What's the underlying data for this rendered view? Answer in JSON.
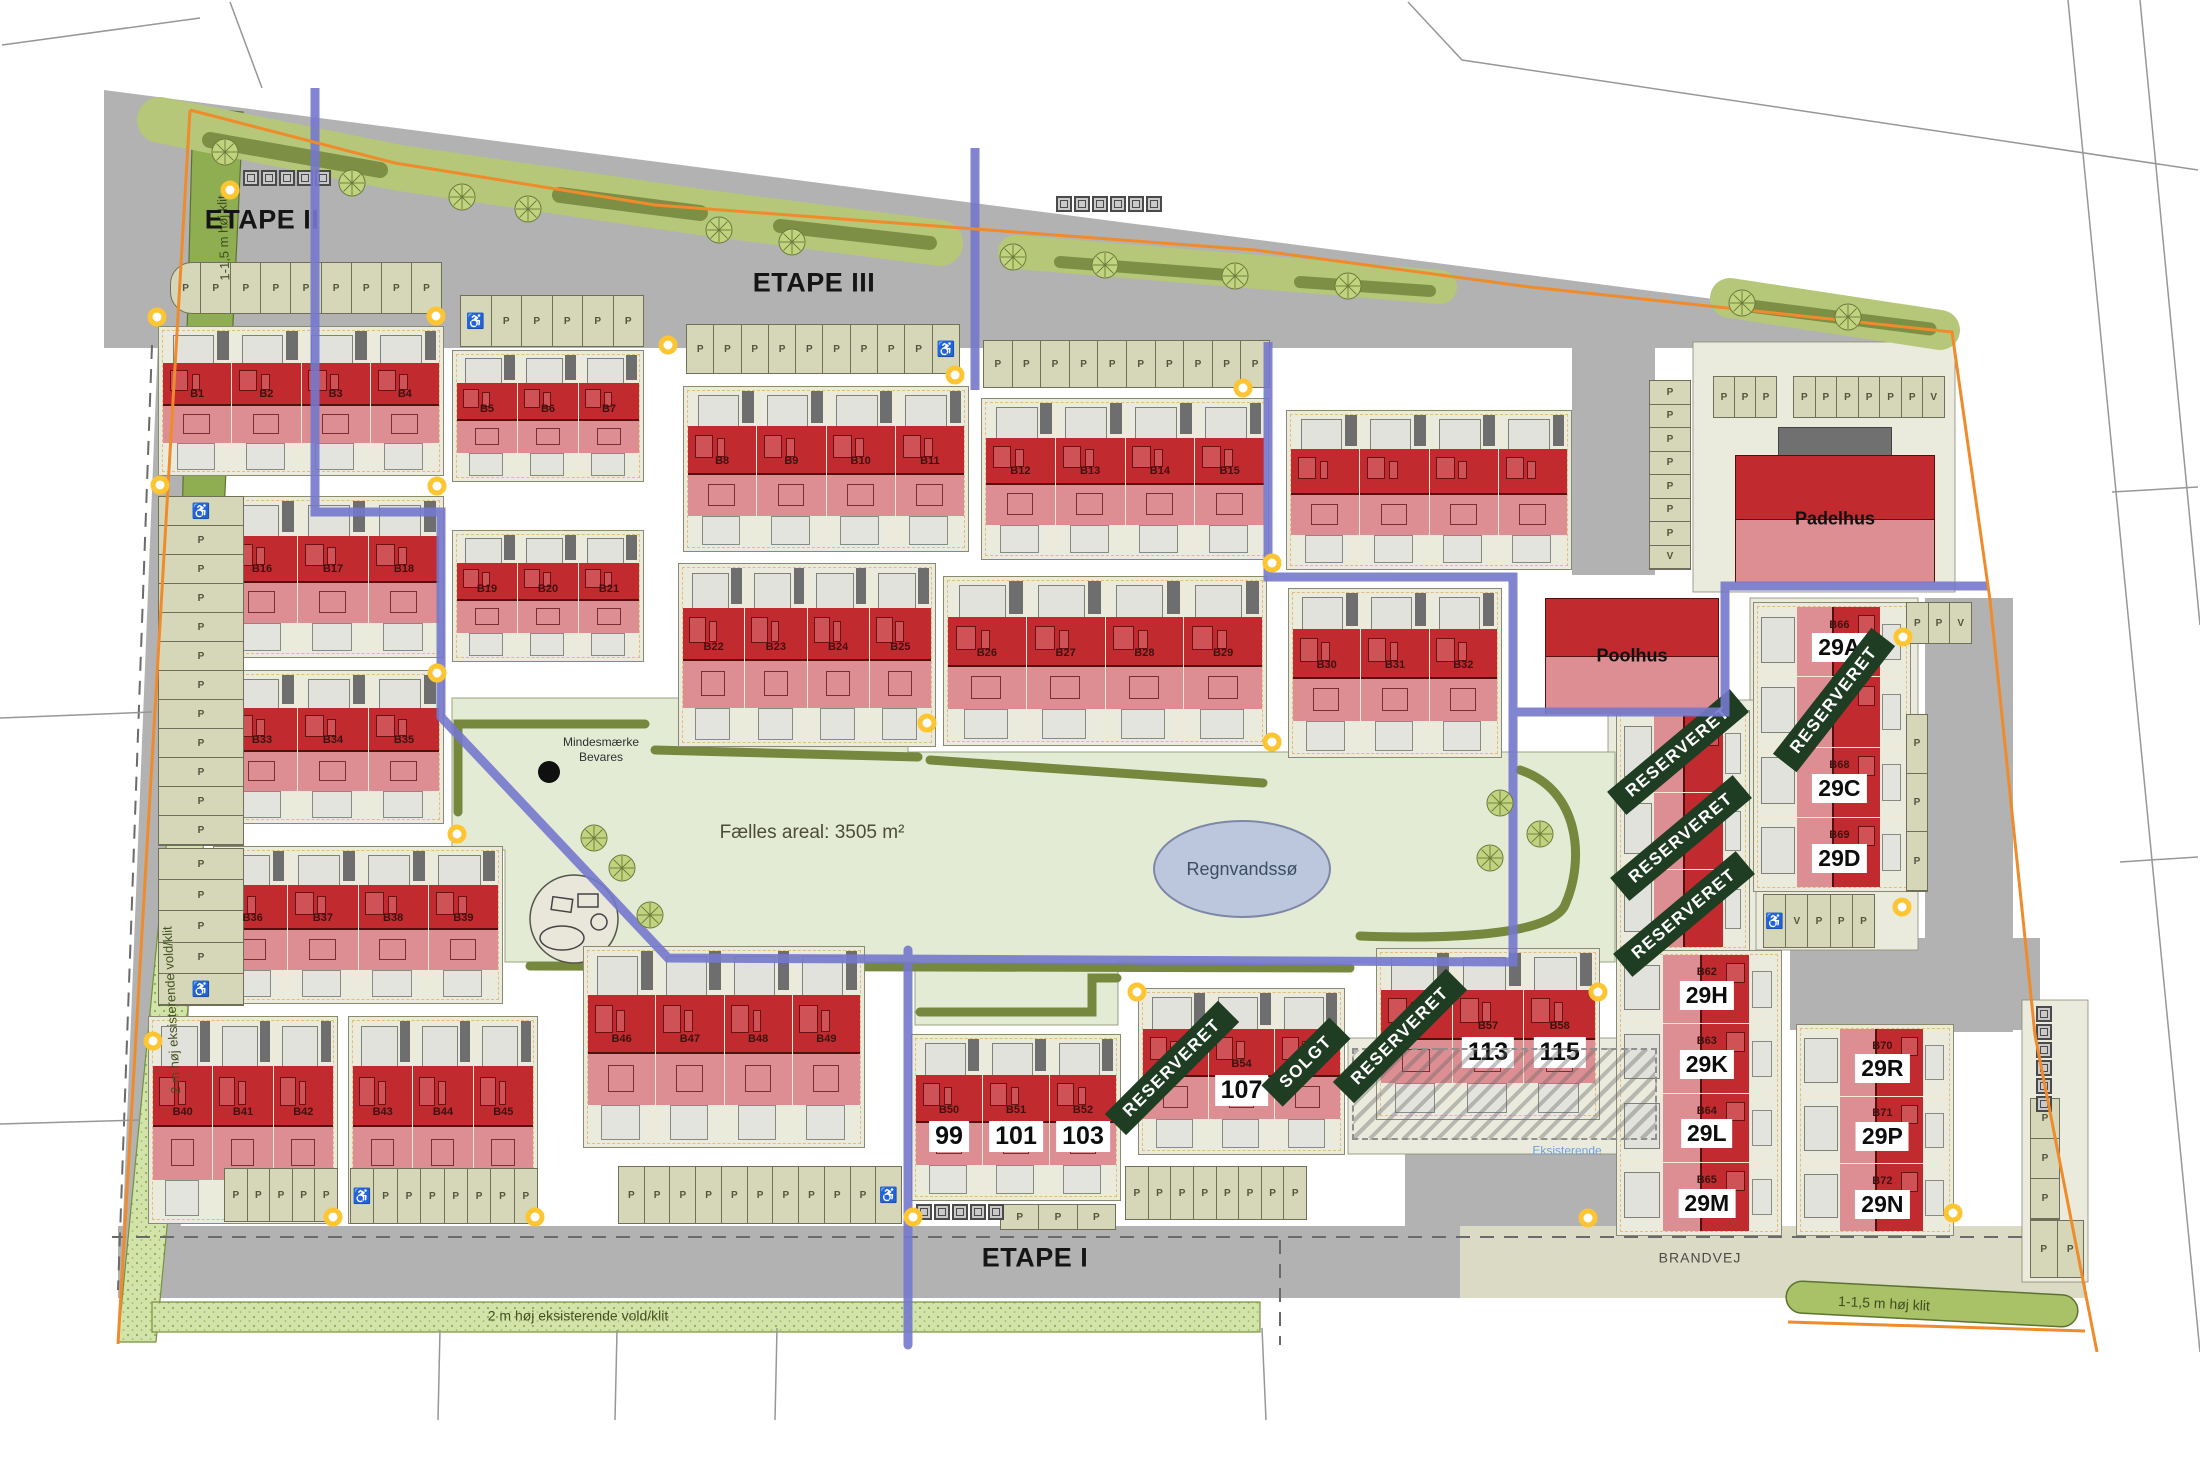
{
  "map": {
    "phases": [
      {
        "id": "etape-2",
        "label": "ETAPE II",
        "x": 262,
        "y": 220
      },
      {
        "id": "etape-3",
        "label": "ETAPE III",
        "x": 814,
        "y": 283
      },
      {
        "id": "etape-1",
        "label": "ETAPE I",
        "x": 1035,
        "y": 1258
      }
    ],
    "area_labels": [
      {
        "id": "faelles-areal",
        "text": "Fælles areal: 3505 m²",
        "x": 812,
        "y": 833,
        "size": 19,
        "color": "#4c4c38",
        "weight": 400
      },
      {
        "id": "regnvandssoe",
        "text": "Regnvandssø",
        "x": 1242,
        "y": 869,
        "size": 18,
        "color": "#3d4e63",
        "weight": 400
      },
      {
        "id": "mindesmaerke",
        "text": "Mindesmærke\nBevares",
        "x": 601,
        "y": 750,
        "size": 12,
        "color": "#2f2f2f",
        "weight": 400
      },
      {
        "id": "brandvej",
        "text": "BRANDVEJ",
        "x": 1700,
        "y": 1258,
        "size": 14,
        "color": "#4a4a4a",
        "weight": 400,
        "spacing": 1
      },
      {
        "id": "eksisterende",
        "text": "Eksisterende",
        "x": 1567,
        "y": 1151,
        "size": 12,
        "color": "#6f9fd8",
        "weight": 400
      },
      {
        "id": "klit-left",
        "text": "1-1,5 m høj klit",
        "x": 224,
        "y": 238,
        "size": 13,
        "color": "#3f4c1f",
        "rot": -92,
        "weight": 400
      },
      {
        "id": "vold-left",
        "text": "2 m høj eksisterende vold/klit",
        "x": 172,
        "y": 1010,
        "size": 13,
        "color": "#44521f",
        "rot": -93,
        "weight": 400
      },
      {
        "id": "vold-bottom",
        "text": "2 m høj eksisterende vold/klit",
        "x": 578,
        "y": 1316,
        "size": 14,
        "color": "#44521f",
        "rot": 0,
        "weight": 400
      },
      {
        "id": "klit-bottom-right",
        "text": "1-1,5 m høj klit",
        "x": 1884,
        "y": 1304,
        "size": 14,
        "color": "#3f4c1f",
        "rot": 3,
        "weight": 400
      }
    ],
    "special_buildings": [
      {
        "name": "Padelhus",
        "lot": [
          1693,
          342,
          262,
          250
        ],
        "bld": [
          1735,
          455,
          198,
          126
        ],
        "garage": [
          1778,
          427,
          112,
          30
        ]
      },
      {
        "name": "Poolhus",
        "lot": [
          1538,
          590,
          188,
          128
        ],
        "bld": [
          1545,
          598,
          172,
          114
        ],
        "garage": null
      }
    ],
    "blocks_h": [
      {
        "x": 158,
        "y": 326,
        "w": 286,
        "h": 150,
        "units": [
          {
            "b": "B1"
          },
          {
            "b": "B2"
          },
          {
            "b": "B3"
          },
          {
            "b": "B4"
          }
        ]
      },
      {
        "x": 452,
        "y": 350,
        "w": 192,
        "h": 132,
        "units": [
          {
            "b": "B5"
          },
          {
            "b": "B6"
          },
          {
            "b": "B7"
          }
        ]
      },
      {
        "x": 683,
        "y": 386,
        "w": 286,
        "h": 166,
        "units": [
          {
            "b": "B8"
          },
          {
            "b": "B9"
          },
          {
            "b": "B10"
          },
          {
            "b": "B11"
          }
        ]
      },
      {
        "x": 981,
        "y": 398,
        "w": 288,
        "h": 162,
        "units": [
          {
            "b": "B12"
          },
          {
            "b": "B13"
          },
          {
            "b": "B14"
          },
          {
            "b": "B15"
          }
        ]
      },
      {
        "x": 1286,
        "y": 410,
        "w": 286,
        "h": 160,
        "units": [
          {},
          {},
          {},
          {}
        ]
      },
      {
        "x": 222,
        "y": 496,
        "w": 222,
        "h": 162,
        "units": [
          {
            "b": "B16"
          },
          {
            "b": "B17"
          },
          {
            "b": "B18"
          }
        ]
      },
      {
        "x": 452,
        "y": 530,
        "w": 192,
        "h": 132,
        "units": [
          {
            "b": "B19"
          },
          {
            "b": "B20"
          },
          {
            "b": "B21"
          }
        ]
      },
      {
        "x": 678,
        "y": 563,
        "w": 258,
        "h": 184,
        "units": [
          {
            "b": "B22"
          },
          {
            "b": "B23"
          },
          {
            "b": "B24"
          },
          {
            "b": "B25"
          }
        ]
      },
      {
        "x": 943,
        "y": 576,
        "w": 324,
        "h": 170,
        "units": [
          {
            "b": "B26"
          },
          {
            "b": "B27"
          },
          {
            "b": "B28"
          },
          {
            "b": "B29"
          }
        ]
      },
      {
        "x": 1288,
        "y": 588,
        "w": 214,
        "h": 170,
        "units": [
          {
            "b": "B30"
          },
          {
            "b": "B31"
          },
          {
            "b": "B32"
          }
        ]
      },
      {
        "x": 222,
        "y": 670,
        "w": 222,
        "h": 154,
        "units": [
          {
            "b": "B33"
          },
          {
            "b": "B34"
          },
          {
            "b": "B35"
          }
        ]
      },
      {
        "x": 213,
        "y": 846,
        "w": 290,
        "h": 158,
        "units": [
          {
            "b": "B36"
          },
          {
            "b": "B37"
          },
          {
            "b": "B38"
          },
          {
            "b": "B39"
          }
        ]
      },
      {
        "x": 148,
        "y": 1016,
        "w": 190,
        "h": 208,
        "units": [
          {
            "b": "B40"
          },
          {
            "b": "B41"
          },
          {
            "b": "B42"
          }
        ]
      },
      {
        "x": 348,
        "y": 1016,
        "w": 190,
        "h": 208,
        "units": [
          {
            "b": "B43"
          },
          {
            "b": "B44"
          },
          {
            "b": "B45"
          }
        ]
      },
      {
        "x": 583,
        "y": 946,
        "w": 282,
        "h": 202,
        "units": [
          {
            "b": "B46"
          },
          {
            "b": "B47"
          },
          {
            "b": "B48"
          },
          {
            "b": "B49"
          }
        ]
      },
      {
        "x": 911,
        "y": 1034,
        "w": 210,
        "h": 167,
        "units": [
          {
            "b": "B50",
            "plate": "99"
          },
          {
            "b": "B51",
            "plate": "101"
          },
          {
            "b": "B52",
            "plate": "103"
          }
        ]
      },
      {
        "x": 1138,
        "y": 988,
        "w": 207,
        "h": 167,
        "units": [
          {
            "b": "B53"
          },
          {
            "b": "B54",
            "plate": "107"
          },
          {
            "b": "B55"
          }
        ]
      },
      {
        "x": 1376,
        "y": 948,
        "w": 224,
        "h": 172,
        "units": [
          {
            "b": "B56"
          },
          {
            "b": "B57",
            "plate": "113"
          },
          {
            "b": "B58",
            "plate": "115"
          }
        ]
      }
    ],
    "blocks_v": [
      {
        "x": 1753,
        "y": 602,
        "w": 158,
        "h": 290,
        "units": [
          {
            "b": "B66",
            "plate": "29A"
          },
          {},
          {
            "b": "B68",
            "plate": "29C"
          },
          {
            "b": "B69",
            "plate": "29D"
          }
        ]
      },
      {
        "x": 1616,
        "y": 710,
        "w": 134,
        "h": 242,
        "units": [
          {},
          {},
          {}
        ]
      },
      {
        "x": 1616,
        "y": 950,
        "w": 166,
        "h": 286,
        "units": [
          {
            "b": "B62",
            "plate": "29H"
          },
          {
            "b": "B63",
            "plate": "29K"
          },
          {
            "b": "B64",
            "plate": "29L"
          },
          {
            "b": "B65",
            "plate": "29M"
          }
        ]
      },
      {
        "x": 1796,
        "y": 1024,
        "w": 158,
        "h": 212,
        "units": [
          {
            "b": "B70",
            "plate": "29R"
          },
          {
            "b": "B71",
            "plate": "29P"
          },
          {
            "b": "B72",
            "plate": "29N"
          }
        ]
      }
    ],
    "badges": [
      {
        "text": "RESERVERET",
        "x": 1678,
        "y": 752,
        "rot": -40
      },
      {
        "text": "RESERVERET",
        "x": 1681,
        "y": 838,
        "rot": -40
      },
      {
        "text": "RESERVERET",
        "x": 1684,
        "y": 914,
        "rot": -40
      },
      {
        "text": "RESERVERET",
        "x": 1834,
        "y": 700,
        "rot": -52
      },
      {
        "text": "RESERVERET",
        "x": 1172,
        "y": 1068,
        "rot": -45
      },
      {
        "text": "SOLGT",
        "x": 1306,
        "y": 1062,
        "rot": -45
      },
      {
        "text": "RESERVERET",
        "x": 1400,
        "y": 1036,
        "rot": -45
      }
    ],
    "parking": [
      {
        "x": 170,
        "y": 262,
        "w": 272,
        "h": 52,
        "o": "h",
        "roundL": true,
        "s": [
          "P",
          "P",
          "P",
          "P",
          "P",
          "P",
          "P",
          "P",
          "P"
        ]
      },
      {
        "x": 460,
        "y": 295,
        "w": 184,
        "h": 52,
        "o": "h",
        "s": [
          "♿",
          "P",
          "P",
          "P",
          "P",
          "P"
        ]
      },
      {
        "x": 686,
        "y": 324,
        "w": 274,
        "h": 50,
        "o": "h",
        "s": [
          "P",
          "P",
          "P",
          "P",
          "P",
          "P",
          "P",
          "P",
          "P",
          "♿"
        ]
      },
      {
        "x": 983,
        "y": 340,
        "w": 287,
        "h": 48,
        "o": "h",
        "s": [
          "P",
          "P",
          "P",
          "P",
          "P",
          "P",
          "P",
          "P",
          "P",
          "P"
        ]
      },
      {
        "x": 1713,
        "y": 376,
        "w": 64,
        "h": 42,
        "o": "h",
        "s": [
          "P",
          "P",
          "P"
        ]
      },
      {
        "x": 1793,
        "y": 376,
        "w": 152,
        "h": 42,
        "o": "h",
        "s": [
          "P",
          "P",
          "P",
          "P",
          "P",
          "P",
          "V"
        ]
      },
      {
        "x": 1649,
        "y": 380,
        "w": 42,
        "h": 190,
        "o": "v",
        "s": [
          "P",
          "P",
          "P",
          "P",
          "P",
          "P",
          "P",
          "V"
        ]
      },
      {
        "x": 158,
        "y": 496,
        "w": 86,
        "h": 350,
        "o": "v",
        "s": [
          "♿",
          "P",
          "P",
          "P",
          "P",
          "P",
          "P",
          "P",
          "P",
          "P",
          "P",
          "P"
        ]
      },
      {
        "x": 158,
        "y": 848,
        "w": 86,
        "h": 158,
        "o": "v",
        "s": [
          "P",
          "P",
          "P",
          "P",
          "♿"
        ]
      },
      {
        "x": 224,
        "y": 1168,
        "w": 114,
        "h": 54,
        "o": "h",
        "s": [
          "P",
          "P",
          "P",
          "P",
          "P"
        ]
      },
      {
        "x": 350,
        "y": 1168,
        "w": 188,
        "h": 56,
        "o": "h",
        "s": [
          "♿",
          "P",
          "P",
          "P",
          "P",
          "P",
          "P",
          "P"
        ]
      },
      {
        "x": 618,
        "y": 1166,
        "w": 284,
        "h": 58,
        "o": "h",
        "s": [
          "P",
          "P",
          "P",
          "P",
          "P",
          "P",
          "P",
          "P",
          "P",
          "P",
          "♿"
        ]
      },
      {
        "x": 1000,
        "y": 1204,
        "w": 116,
        "h": 26,
        "o": "h",
        "s": [
          "P",
          "P",
          "P"
        ]
      },
      {
        "x": 1125,
        "y": 1166,
        "w": 182,
        "h": 54,
        "o": "h",
        "s": [
          "P",
          "P",
          "P",
          "P",
          "P",
          "P",
          "P",
          "P"
        ]
      },
      {
        "x": 1906,
        "y": 602,
        "w": 66,
        "h": 42,
        "o": "h",
        "s": [
          "P",
          "P",
          "V"
        ]
      },
      {
        "x": 1906,
        "y": 714,
        "w": 22,
        "h": 178,
        "o": "v",
        "s": [
          "P",
          "P",
          "P"
        ]
      },
      {
        "x": 1763,
        "y": 894,
        "w": 112,
        "h": 54,
        "o": "h",
        "s": [
          "♿",
          "V",
          "P",
          "P",
          "P"
        ]
      },
      {
        "x": 2030,
        "y": 1098,
        "w": 30,
        "h": 122,
        "o": "v",
        "s": [
          "P",
          "P",
          "P"
        ]
      },
      {
        "x": 2030,
        "y": 1220,
        "w": 54,
        "h": 58,
        "o": "h",
        "s": [
          "P",
          "P"
        ]
      }
    ],
    "containers": [
      {
        "x": 243,
        "y": 170,
        "n": 5,
        "o": "h"
      },
      {
        "x": 1056,
        "y": 196,
        "n": 6,
        "o": "h"
      },
      {
        "x": 916,
        "y": 1204,
        "n": 5,
        "o": "h"
      },
      {
        "x": 2036,
        "y": 1006,
        "n": 6,
        "o": "v"
      }
    ],
    "trees": [
      [
        225,
        152
      ],
      [
        352,
        183
      ],
      [
        462,
        197
      ],
      [
        528,
        209
      ],
      [
        719,
        230
      ],
      [
        792,
        242
      ],
      [
        1013,
        257
      ],
      [
        1105,
        265
      ],
      [
        1235,
        276
      ],
      [
        1348,
        286
      ],
      [
        1742,
        303
      ],
      [
        1848,
        317
      ],
      [
        594,
        838
      ],
      [
        622,
        868
      ],
      [
        650,
        915
      ],
      [
        1500,
        803
      ],
      [
        1540,
        834
      ],
      [
        1490,
        858
      ]
    ],
    "dots": [
      [
        230,
        190
      ],
      [
        157,
        317
      ],
      [
        436,
        316
      ],
      [
        668,
        345
      ],
      [
        955,
        375
      ],
      [
        160,
        485
      ],
      [
        437,
        486
      ],
      [
        437,
        673
      ],
      [
        153,
        1041
      ],
      [
        333,
        1217
      ],
      [
        535,
        1217
      ],
      [
        913,
        1217
      ],
      [
        1137,
        992
      ],
      [
        1272,
        563
      ],
      [
        1272,
        742
      ],
      [
        1243,
        388
      ],
      [
        1598,
        992
      ],
      [
        1588,
        1218
      ],
      [
        1953,
        1213
      ],
      [
        1902,
        907
      ],
      [
        1903,
        637
      ],
      [
        457,
        834
      ],
      [
        927,
        723
      ]
    ],
    "pond": {
      "label": "Regnvandssø",
      "cx": 1242,
      "cy": 869,
      "rx": 88,
      "ry": 48
    },
    "memorial": {
      "x": 549,
      "y": 772,
      "r": 11
    },
    "colors": {
      "building_red": "#c12b30",
      "building_pink": "#dd8e92",
      "badge_green": "#1e3d22",
      "phase_line_blue": "#7478cc",
      "boundary_orange": "#ef8b2b",
      "road_gray": "#b2b2b2",
      "parking_olive": "#d5d7b8",
      "pond_blue": "#bcc6dd",
      "lot_cream": "#eaebdc"
    }
  }
}
